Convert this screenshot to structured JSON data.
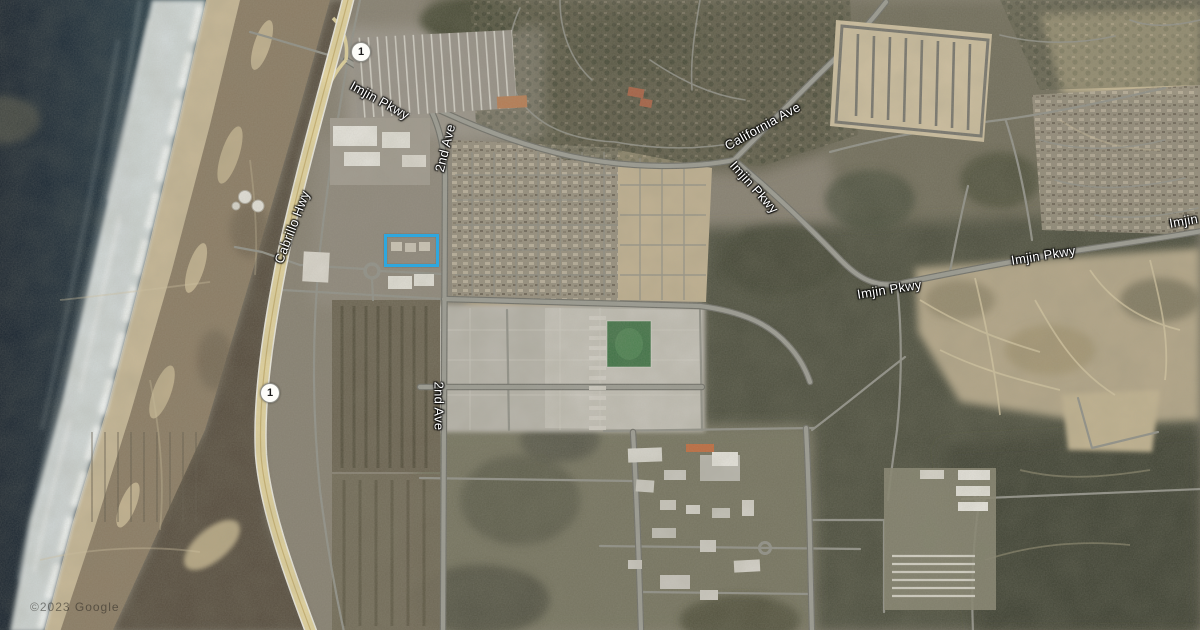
{
  "map": {
    "view": "satellite",
    "attribution": "©2023 Google",
    "road_labels": [
      {
        "id": "imjin-pkwy-nw",
        "text": "Imjin Pkwy"
      },
      {
        "id": "california-ave",
        "text": "California Ave"
      },
      {
        "id": "imjin-pkwy-mid",
        "text": "Imjin Pkwy"
      },
      {
        "id": "imjin-pkwy-east",
        "text": "Imjin Pkwy"
      },
      {
        "id": "imjin-pkwy-far",
        "text": "Imjin Pkwy"
      },
      {
        "id": "imjin-pkwy-edge",
        "text": "Imjin Pkwy"
      },
      {
        "id": "2nd-ave-north",
        "text": "2nd Ave"
      },
      {
        "id": "2nd-ave-south",
        "text": "2nd Ave"
      },
      {
        "id": "cabrillo-hwy",
        "text": "Cabrillo Hwy"
      }
    ],
    "route_shields": [
      {
        "route": "1"
      },
      {
        "route": "1"
      }
    ],
    "highlight_color": "#2fa7de"
  }
}
